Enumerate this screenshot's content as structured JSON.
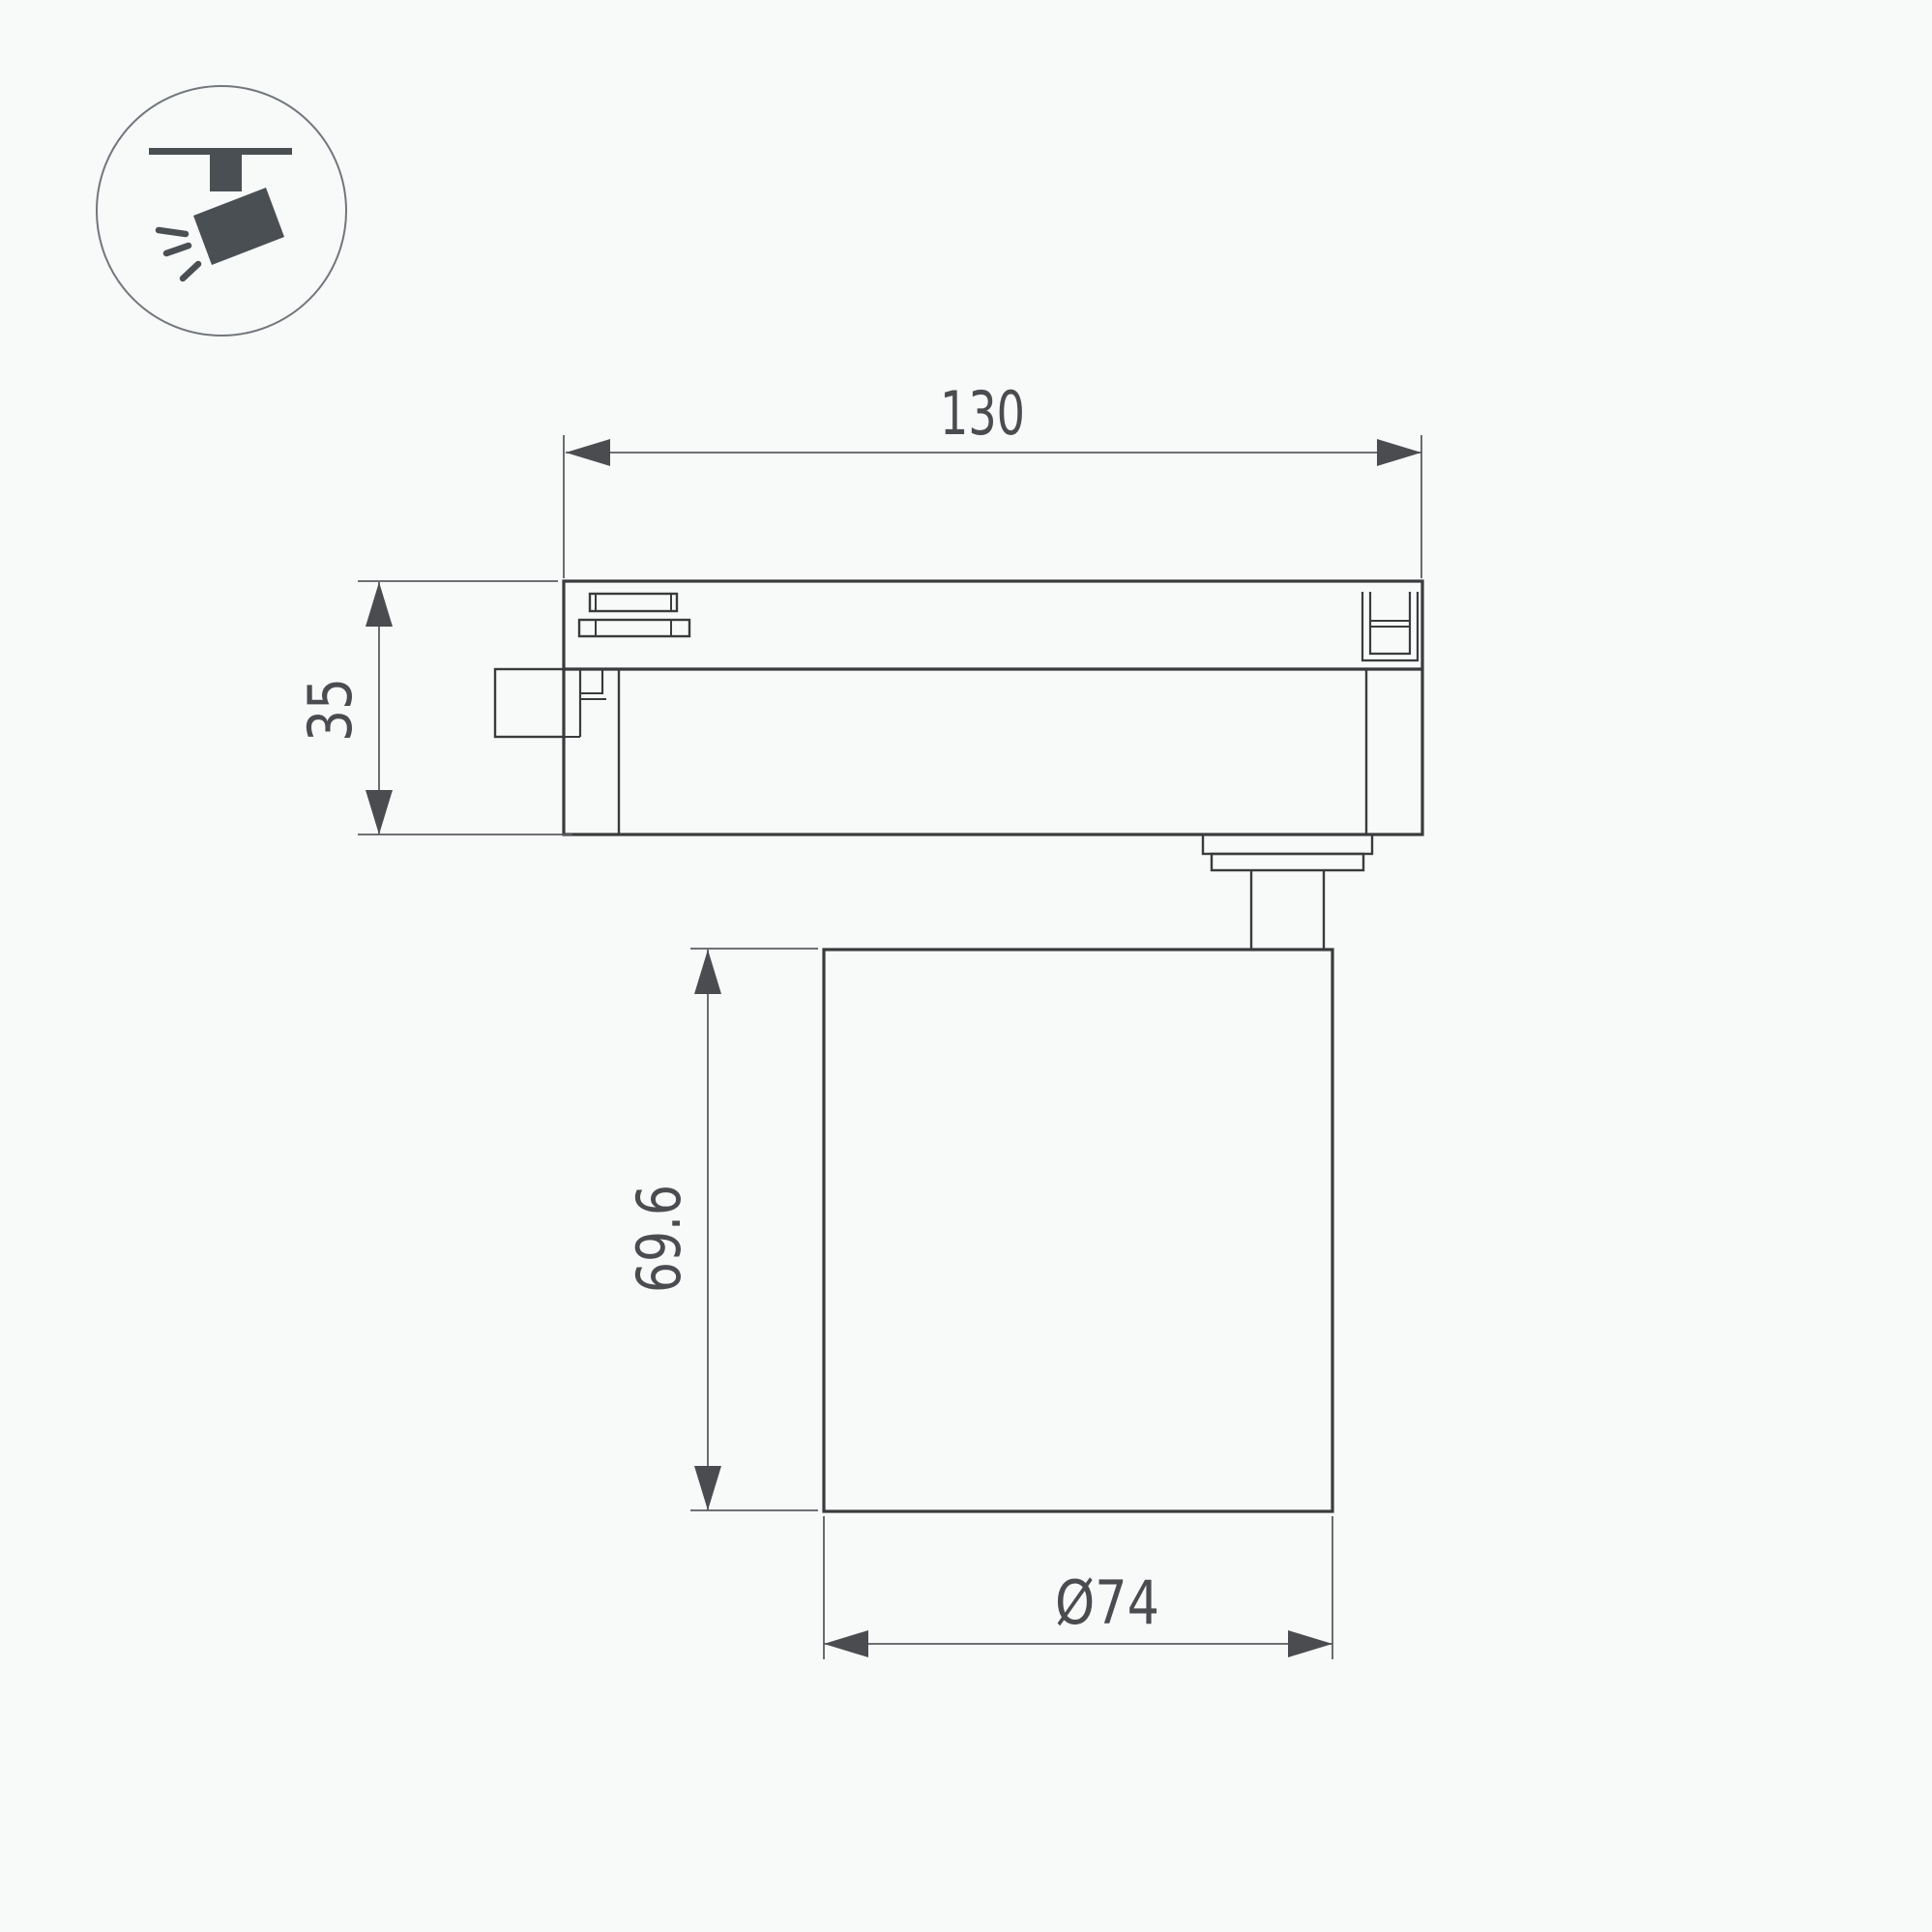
{
  "page": {
    "background": "#f8f9f9",
    "description": "Technical dimension drawing of LED track spotlight"
  },
  "icon": {
    "name": "track-spotlight-icon",
    "color": "#4a4f54",
    "circle_stroke": "#72777c"
  },
  "drawing": {
    "stroke_color": "#3a3b3d",
    "dimension_line_color": "#5c5d61",
    "dimension_text_color": "#4b4c50",
    "dimensions": {
      "track_adapter_width": {
        "label": "130"
      },
      "track_adapter_height": {
        "label": "35"
      },
      "lamp_body_height": {
        "label": "69.6"
      },
      "lamp_body_diameter": {
        "label": "Ø74"
      }
    }
  }
}
